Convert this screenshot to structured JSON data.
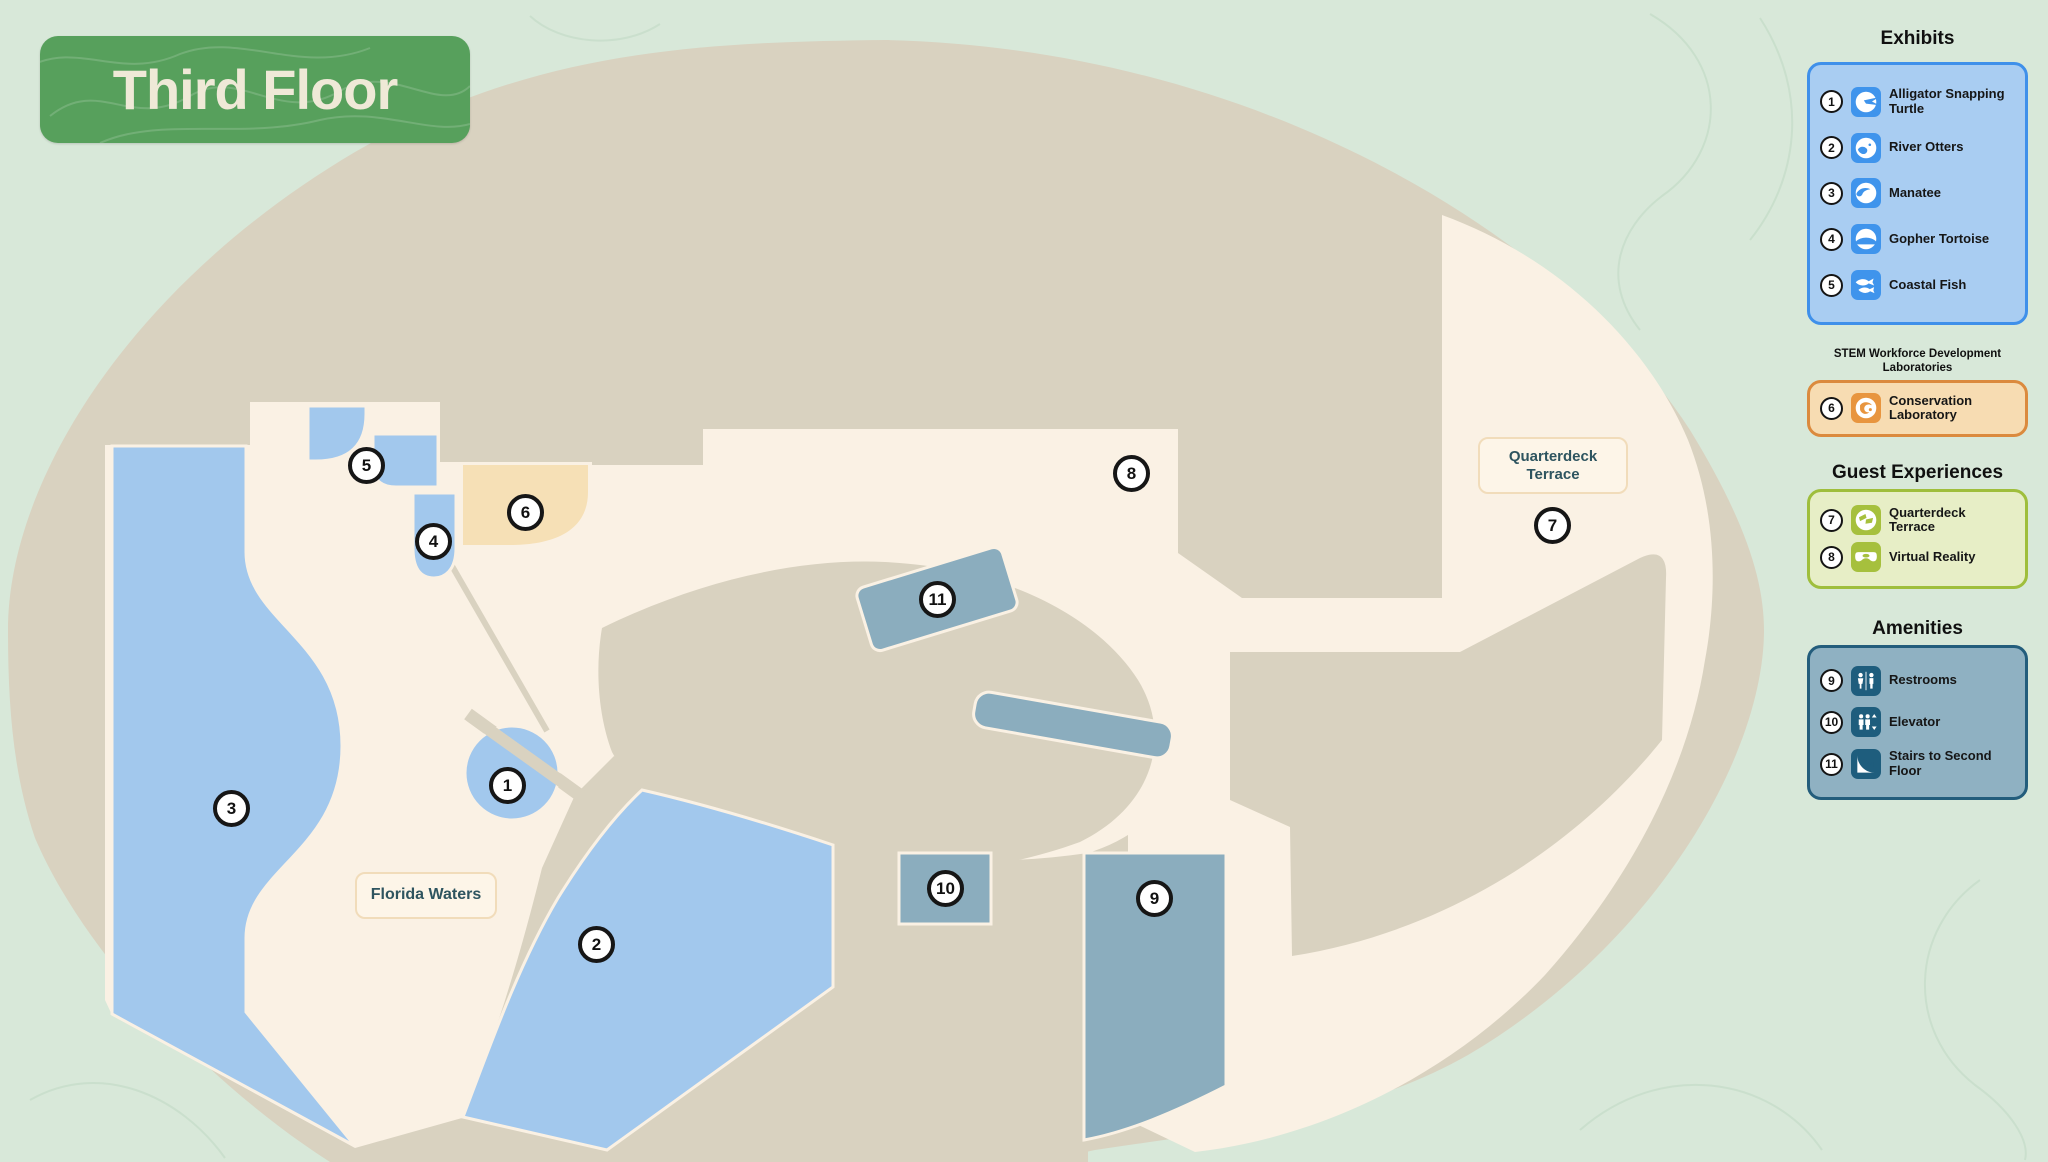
{
  "page": {
    "floor_title": "Third Floor"
  },
  "map": {
    "labels": {
      "florida_waters": "Florida Waters",
      "quarterdeck_terrace": "Quarterdeck Terrace"
    },
    "markers": [
      {
        "number": "1"
      },
      {
        "number": "2"
      },
      {
        "number": "3"
      },
      {
        "number": "4"
      },
      {
        "number": "5"
      },
      {
        "number": "6"
      },
      {
        "number": "7"
      },
      {
        "number": "8"
      },
      {
        "number": "9"
      },
      {
        "number": "10"
      },
      {
        "number": "11"
      }
    ]
  },
  "legend": {
    "sections": [
      {
        "title": "Exhibits",
        "items": [
          {
            "number": "1",
            "label": "Alligator Snapping Turtle",
            "icon": "alligator-snapping-turtle"
          },
          {
            "number": "2",
            "label": "River Otters",
            "icon": "river-otters"
          },
          {
            "number": "3",
            "label": "Manatee",
            "icon": "manatee"
          },
          {
            "number": "4",
            "label": "Gopher Tortoise",
            "icon": "gopher-tortoise"
          },
          {
            "number": "5",
            "label": "Coastal Fish",
            "icon": "coastal-fish"
          }
        ]
      },
      {
        "title": "STEM Workforce Development Laboratories",
        "items": [
          {
            "number": "6",
            "label": "Conservation Laboratory",
            "icon": "conservation-laboratory"
          }
        ]
      },
      {
        "title": "Guest Experiences",
        "items": [
          {
            "number": "7",
            "label": "Quarterdeck Terrace",
            "icon": "quarterdeck-terrace"
          },
          {
            "number": "8",
            "label": "Virtual Reality",
            "icon": "virtual-reality"
          }
        ]
      },
      {
        "title": "Amenities",
        "items": [
          {
            "number": "9",
            "label": "Restrooms",
            "icon": "restrooms"
          },
          {
            "number": "10",
            "label": "Elevator",
            "icon": "elevator"
          },
          {
            "number": "11",
            "label": "Stairs to Second Floor",
            "icon": "stairs-to-second-floor"
          }
        ]
      }
    ]
  },
  "colors": {
    "background_mint": "#d8e8d9",
    "map_tan": "#d9d2c0",
    "map_cream": "#faf1e4",
    "water_blue": "#a2c8ed",
    "amenity_blue_gray": "#8badbe",
    "lab_orange": "#f6e0b6",
    "title_green": "#57a05c",
    "exhibits_fill": "#a9cdf2",
    "exhibits_border": "#3f90ea",
    "stem_fill": "#f7dcb2",
    "stem_border": "#db8a3e",
    "guest_fill": "#e7eec6",
    "guest_border": "#9fbe3c",
    "amenities_fill": "#8fb1c2",
    "amenities_border": "#235d7c",
    "label_teal": "#2e545f"
  }
}
